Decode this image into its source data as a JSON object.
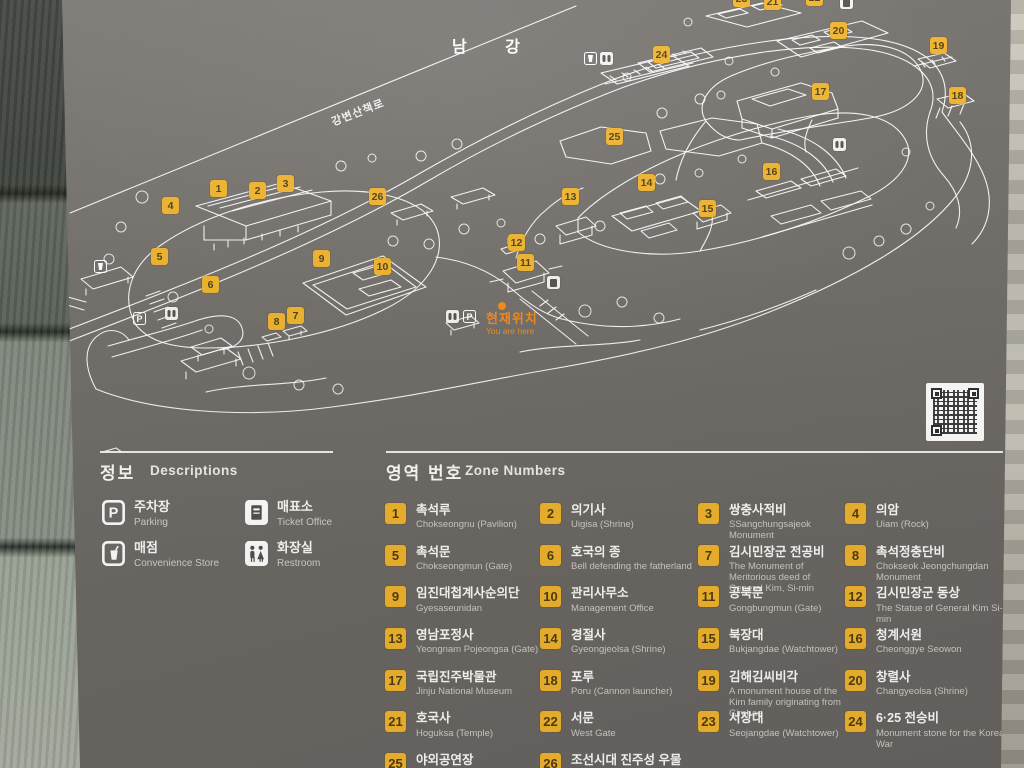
{
  "map": {
    "river_label": "남 강",
    "riverside_path_label": "강변산책로",
    "you_are_here": {
      "kr": "현재위치",
      "en": "You are here"
    },
    "markers": [
      {
        "num": "1",
        "x": 210,
        "y": 180
      },
      {
        "num": "2",
        "x": 249,
        "y": 182
      },
      {
        "num": "3",
        "x": 277,
        "y": 175
      },
      {
        "num": "4",
        "x": 162,
        "y": 197
      },
      {
        "num": "5",
        "x": 151,
        "y": 248
      },
      {
        "num": "6",
        "x": 202,
        "y": 276
      },
      {
        "num": "7",
        "x": 287,
        "y": 307
      },
      {
        "num": "8",
        "x": 268,
        "y": 313
      },
      {
        "num": "9",
        "x": 313,
        "y": 250
      },
      {
        "num": "10",
        "x": 374,
        "y": 258
      },
      {
        "num": "11",
        "x": 517,
        "y": 254
      },
      {
        "num": "12",
        "x": 508,
        "y": 234
      },
      {
        "num": "13",
        "x": 562,
        "y": 188
      },
      {
        "num": "14",
        "x": 638,
        "y": 174
      },
      {
        "num": "15",
        "x": 699,
        "y": 200
      },
      {
        "num": "16",
        "x": 763,
        "y": 163
      },
      {
        "num": "17",
        "x": 812,
        "y": 83
      },
      {
        "num": "18",
        "x": 949,
        "y": 87
      },
      {
        "num": "19",
        "x": 930,
        "y": 37
      },
      {
        "num": "20",
        "x": 830,
        "y": 22
      },
      {
        "num": "21",
        "x": 764,
        "y": -7
      },
      {
        "num": "22",
        "x": 806,
        "y": -11
      },
      {
        "num": "23",
        "x": 733,
        "y": -10
      },
      {
        "num": "24",
        "x": 653,
        "y": 46
      },
      {
        "num": "25",
        "x": 606,
        "y": 128
      },
      {
        "num": "26",
        "x": 369,
        "y": 188
      }
    ],
    "facilities": [
      {
        "type": "convenience-store-icon",
        "x": 584,
        "y": 52
      },
      {
        "type": "restroom-icon",
        "x": 600,
        "y": 52
      },
      {
        "type": "ticket-office-icon",
        "x": 840,
        "y": -4
      },
      {
        "type": "restroom-icon",
        "x": 833,
        "y": 138
      },
      {
        "type": "ticket-office-icon",
        "x": 547,
        "y": 276
      },
      {
        "type": "restroom-icon",
        "x": 446,
        "y": 310
      },
      {
        "type": "parking-icon",
        "x": 463,
        "y": 310,
        "label": "P"
      },
      {
        "type": "parking-icon",
        "x": 133,
        "y": 312,
        "label": "P"
      },
      {
        "type": "restroom-icon",
        "x": 165,
        "y": 307
      },
      {
        "type": "convenience-store-icon",
        "x": 94,
        "y": 260
      }
    ]
  },
  "descriptions": {
    "title_kr": "정보",
    "title_en": "Descriptions",
    "items": [
      {
        "kr": "주차장",
        "en": "Parking",
        "icon": "parking-icon",
        "symbol": "P"
      },
      {
        "kr": "매표소",
        "en": "Ticket Office",
        "icon": "ticket-office-icon"
      },
      {
        "kr": "매점",
        "en": "Convenience Store",
        "icon": "convenience-store-icon"
      },
      {
        "kr": "화장실",
        "en": "Restroom",
        "icon": "restroom-icon"
      }
    ]
  },
  "zones": {
    "title_kr": "영역 번호",
    "title_en": "Zone Numbers",
    "items": [
      {
        "num": "1",
        "kr": "촉석루",
        "en": "Chokseongnu (Pavilion)"
      },
      {
        "num": "2",
        "kr": "의기사",
        "en": "Uigisa (Shrine)"
      },
      {
        "num": "3",
        "kr": "쌍충사적비",
        "en": "SSangchungsajeok Monument"
      },
      {
        "num": "4",
        "kr": "의암",
        "en": "Uiam (Rock)"
      },
      {
        "num": "5",
        "kr": "촉석문",
        "en": "Chokseongmun (Gate)"
      },
      {
        "num": "6",
        "kr": "호국의 종",
        "en": "Bell defending the fatherland"
      },
      {
        "num": "7",
        "kr": "김시민장군 전공비",
        "en": "The Monument of Meritorious deed of General Kim, Si-min"
      },
      {
        "num": "8",
        "kr": "촉석정충단비",
        "en": "Chokseok Jeongchungdan Monument"
      },
      {
        "num": "9",
        "kr": "임진대첩계사순의단",
        "en": "Gyesaseunidan"
      },
      {
        "num": "10",
        "kr": "관리사무소",
        "en": "Management Office"
      },
      {
        "num": "11",
        "kr": "공북문",
        "en": "Gongbungmun (Gate)"
      },
      {
        "num": "12",
        "kr": "김시민장군 동상",
        "en": "The Statue of General Kim Si-min"
      },
      {
        "num": "13",
        "kr": "영남포정사",
        "en": "Yeongnam Pojeongsa (Gate)"
      },
      {
        "num": "14",
        "kr": "경절사",
        "en": "Gyeongjeolsa (Shrine)"
      },
      {
        "num": "15",
        "kr": "북장대",
        "en": "Bukjangdae (Watchtower)"
      },
      {
        "num": "16",
        "kr": "청계서원",
        "en": "Cheonggye Seowon"
      },
      {
        "num": "17",
        "kr": "국립진주박물관",
        "en": "Jinju National Museum"
      },
      {
        "num": "18",
        "kr": "포루",
        "en": "Poru (Cannon launcher)"
      },
      {
        "num": "19",
        "kr": "김해김씨비각",
        "en": "A monument house of the Kim family originating from Gimhae"
      },
      {
        "num": "20",
        "kr": "창렬사",
        "en": "Changyeolsa (Shrine)"
      },
      {
        "num": "21",
        "kr": "호국사",
        "en": "Hoguksa (Temple)"
      },
      {
        "num": "22",
        "kr": "서문",
        "en": "West Gate"
      },
      {
        "num": "23",
        "kr": "서장대",
        "en": "Seojangdae (Watchtower)"
      },
      {
        "num": "24",
        "kr": "6·25 전승비",
        "en": "Monument stone for the Korean War"
      },
      {
        "num": "25",
        "kr": "야외공연장",
        "en": "Outdoor Stage"
      },
      {
        "num": "26",
        "kr": "조선시대 진주성 우물",
        "en": "Jinjuseong Well of Joseon Dynasty"
      }
    ]
  },
  "colors": {
    "marker_yellow": "#efb32d",
    "highlight_orange": "#f28a1c"
  }
}
